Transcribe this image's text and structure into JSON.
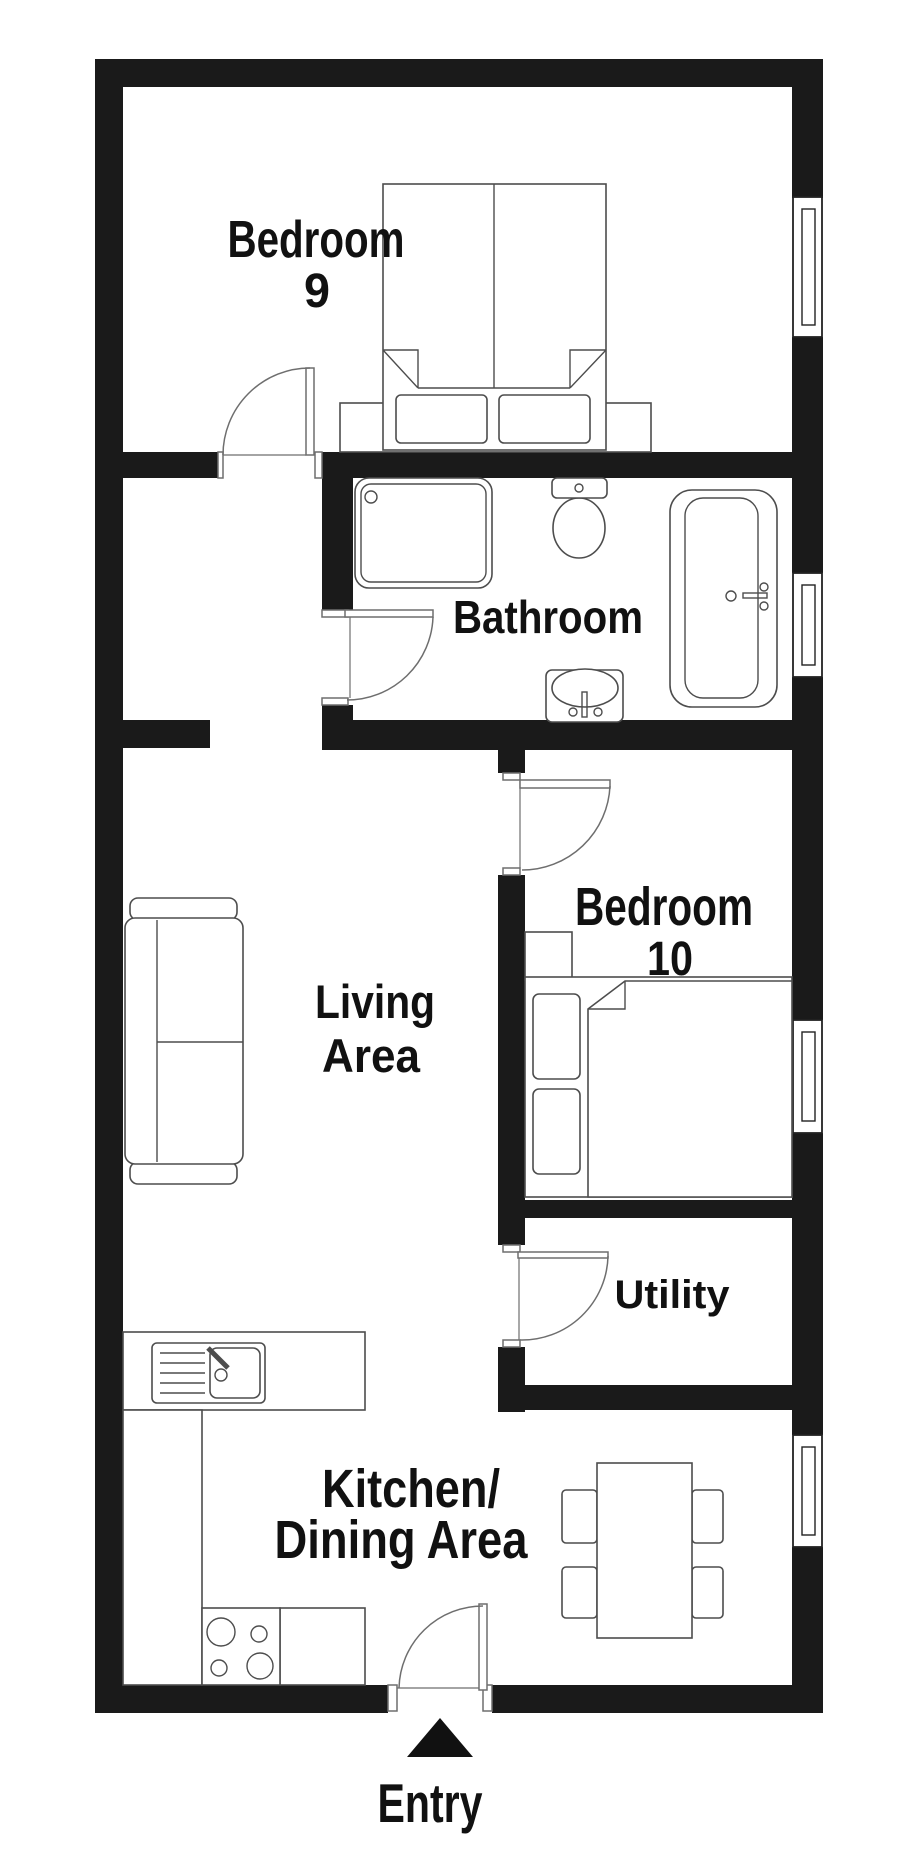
{
  "title": "Apartment floor plan",
  "colors": {
    "wall": "#1a1a1a",
    "fixture_line": "#4d4d4d",
    "door_line": "#6e6e6e",
    "text": "#111111",
    "background": "#ffffff"
  },
  "rooms": {
    "bedroom9": {
      "line1": "Bedroom",
      "line2": "9"
    },
    "bathroom": {
      "label": "Bathroom"
    },
    "living": {
      "line1": "Living",
      "line2": "Area"
    },
    "bedroom10": {
      "line1": "Bedroom",
      "line2": "10"
    },
    "utility": {
      "label": "Utility"
    },
    "kitchen": {
      "line1": "Kitchen/",
      "line2": "Dining Area"
    }
  },
  "entry": {
    "label": "Entry"
  },
  "fixtures": [
    "double-bed",
    "shower",
    "toilet",
    "bathtub",
    "wash-basin",
    "sofa",
    "single-bed",
    "bedside-table",
    "kitchen-counter",
    "kitchen-sink",
    "stove-hob",
    "dining-table",
    "dining-chair",
    "window",
    "door-swing",
    "entry-arrow"
  ]
}
